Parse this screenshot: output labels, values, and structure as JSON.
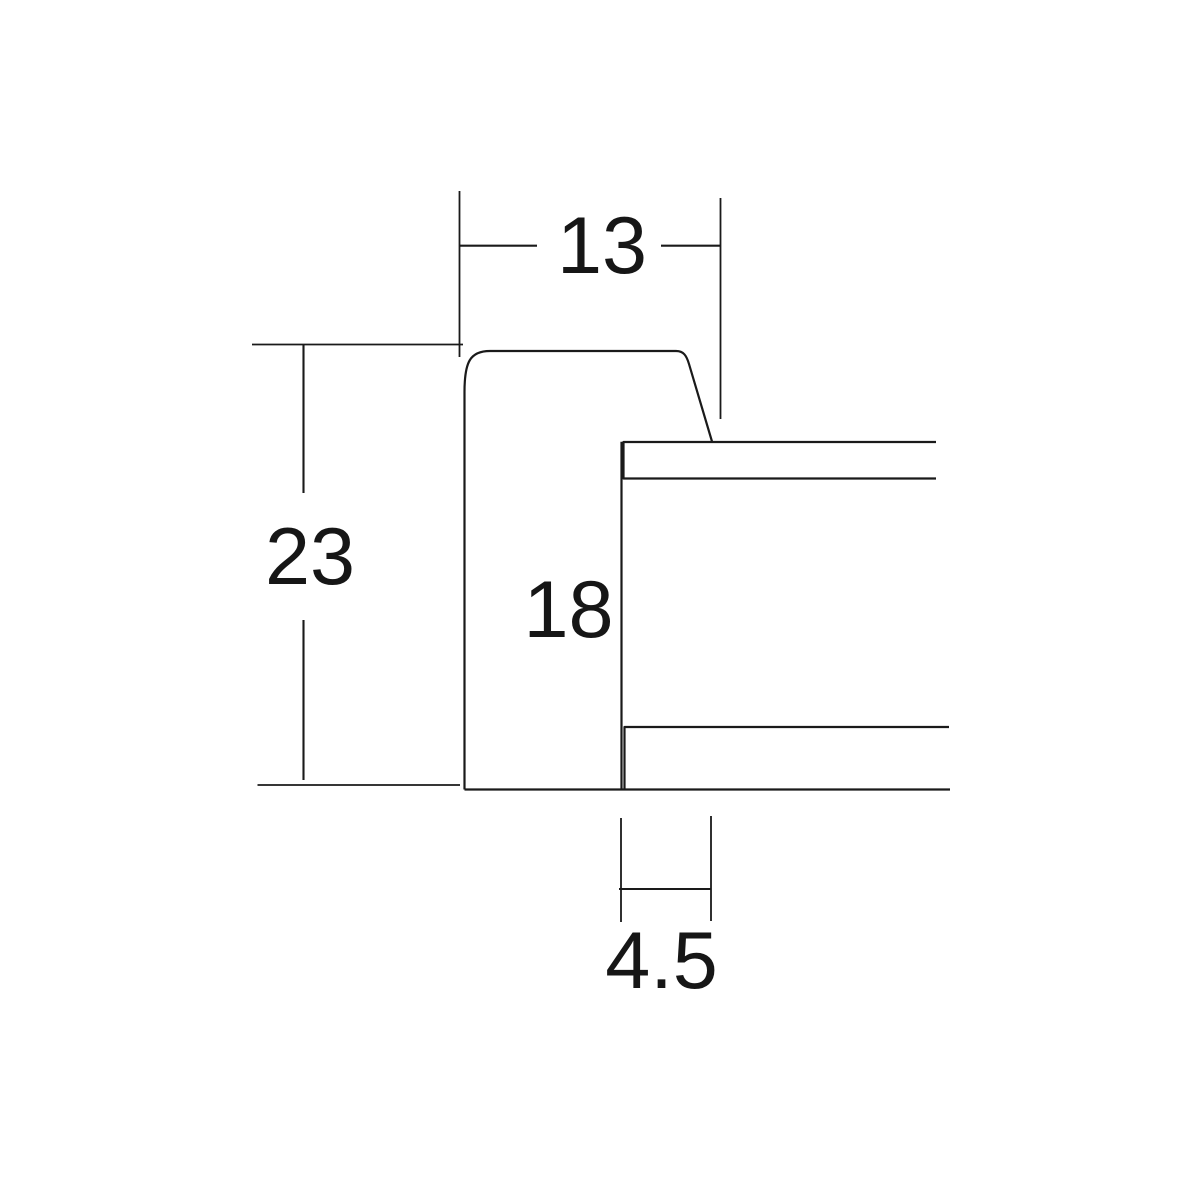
{
  "diagram": {
    "kind": "technical cross-section drawing",
    "background_color": "#ffffff",
    "line_color": "#1a1a1a",
    "dimensions": {
      "top_width": "13",
      "left_height": "23",
      "inner_depth": "18",
      "bottom_width": "4.5"
    }
  }
}
